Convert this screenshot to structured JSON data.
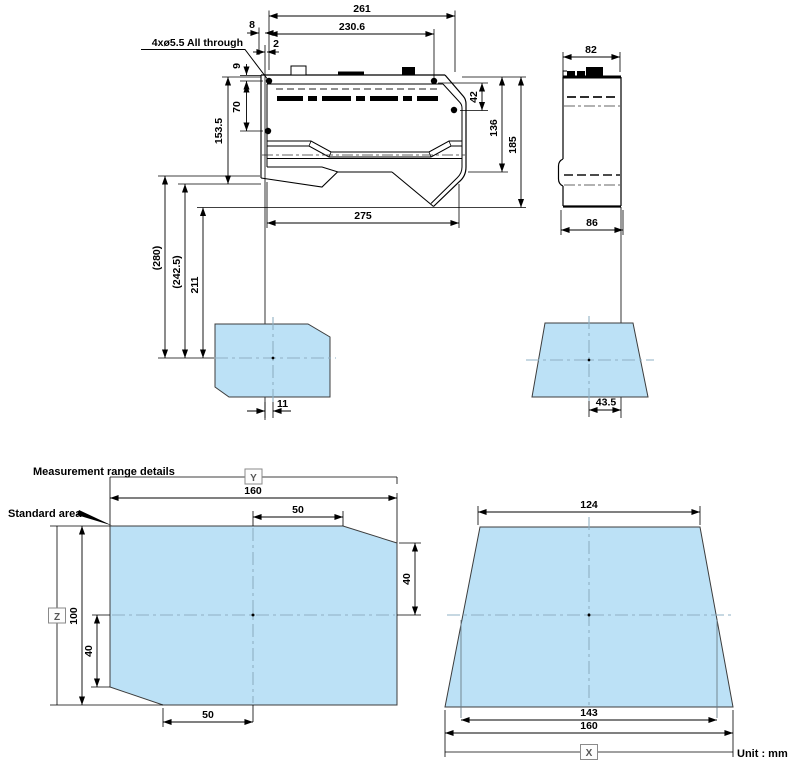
{
  "drawing": {
    "callout": "4xø5.5 All through",
    "unit": "Unit : mm",
    "front": {
      "d261": "261",
      "d230_6": "230.6",
      "d8": "8",
      "d2": "2",
      "d9": "9",
      "d70": "70",
      "d153_5": "153.5",
      "d42": "42",
      "d136": "136",
      "d185": "185",
      "d275": "275",
      "d280": "(280)",
      "d242_5": "(242.5)",
      "d211": "211",
      "d11": "11"
    },
    "side": {
      "d82": "82",
      "d86": "86",
      "d43_5": "43.5"
    },
    "range": {
      "title": "Measurement range details",
      "standard": "Standard area",
      "x": "X",
      "y": "Y",
      "z": "Z",
      "front": {
        "w": "160",
        "h": "100",
        "t50": "50",
        "r40": "40",
        "l40": "40",
        "b50": "50"
      },
      "side": {
        "t124": "124",
        "m143": "143",
        "b160": "160"
      }
    },
    "colors": {
      "area_fill": "#bce1f6",
      "centerline": "#8fb0c4",
      "line": "#000000"
    }
  }
}
